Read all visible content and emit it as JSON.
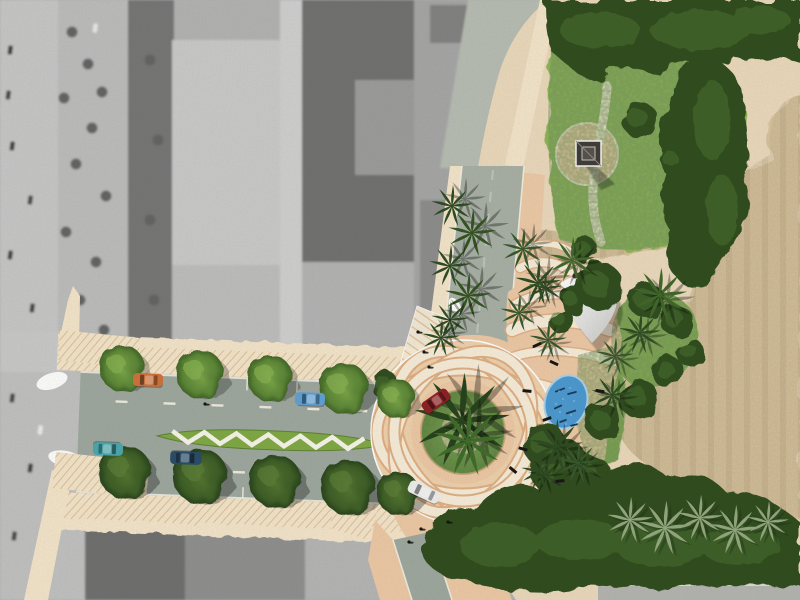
{
  "scene": {
    "kind": "urban-design-site-plan-over-aerial-photo",
    "features": [
      "grayscale-aerial-photo",
      "roundabout-with-guilloche-paving",
      "boulevard-with-chevron-median",
      "palm-trees",
      "park-lawn",
      "monument-plaza",
      "curved-park-path",
      "oval-pond",
      "shade-sail",
      "sand-field",
      "dense-foliage"
    ]
  },
  "palette": {
    "photoBase": "#b2b2b2",
    "planBase": "#ead8ba",
    "sand": "#d6c19a",
    "sandEdge": "#c9b288",
    "lawn": "#8cb355",
    "lawnDeep": "#6d9440",
    "foliageDark": "#2e4c1e",
    "foliageMid": "#49712f",
    "peach": "#ecc8a4",
    "peachDeep": "#dfae82",
    "cream": "#f6ecd8",
    "creamSide": "#f3e4c9",
    "hatchLine": "#dcc096",
    "road": "#9da79d",
    "roadNorth": "#a7afa4",
    "curb": "#f6f2e6",
    "median": "#7fa843",
    "chevron": "#f7f4ea",
    "pond": "#4a98cf",
    "pondRim": "#a9d0ea",
    "ripple": "#16395c",
    "sailWhite": "#f4f4f2",
    "sailDark": "#4a4038",
    "monument": "#3e3a36",
    "palmDark": "#2c4a21",
    "palmMid": "#3e6628",
    "palmPale": "#93a77e"
  },
  "objects": {
    "foliageBlobs": [
      {
        "x": 600,
        "y": 287,
        "r": 24
      },
      {
        "x": 646,
        "y": 300,
        "r": 18
      },
      {
        "x": 676,
        "y": 320,
        "r": 16
      },
      {
        "x": 690,
        "y": 352,
        "r": 14
      },
      {
        "x": 668,
        "y": 372,
        "r": 16
      },
      {
        "x": 638,
        "y": 398,
        "r": 20
      },
      {
        "x": 603,
        "y": 422,
        "r": 18
      },
      {
        "x": 572,
        "y": 300,
        "r": 13
      },
      {
        "x": 560,
        "y": 320,
        "r": 12
      },
      {
        "x": 585,
        "y": 250,
        "r": 13
      },
      {
        "x": 640,
        "y": 120,
        "r": 18
      },
      {
        "x": 672,
        "y": 160,
        "r": 14
      },
      {
        "x": 385,
        "y": 385,
        "r": 14
      },
      {
        "x": 560,
        "y": 468,
        "r": 30
      },
      {
        "x": 545,
        "y": 445,
        "r": 22
      },
      {
        "x": 588,
        "y": 478,
        "r": 24
      }
    ],
    "trees": [
      {
        "x": 122,
        "y": 368,
        "s": 1.0,
        "t": "L"
      },
      {
        "x": 200,
        "y": 374,
        "s": 1.05,
        "t": "L"
      },
      {
        "x": 270,
        "y": 378,
        "s": 1.0,
        "t": "L"
      },
      {
        "x": 344,
        "y": 388,
        "s": 1.1,
        "t": "L"
      },
      {
        "x": 396,
        "y": 398,
        "s": 0.85,
        "t": "L"
      },
      {
        "x": 125,
        "y": 472,
        "s": 1.1,
        "t": "D"
      },
      {
        "x": 200,
        "y": 476,
        "s": 1.15,
        "t": "D"
      },
      {
        "x": 275,
        "y": 481,
        "s": 1.1,
        "t": "D"
      },
      {
        "x": 348,
        "y": 487,
        "s": 1.15,
        "t": "D"
      },
      {
        "x": 398,
        "y": 493,
        "s": 0.9,
        "t": "D"
      }
    ],
    "palms": [
      {
        "x": 452,
        "y": 206,
        "s": 1.0,
        "c": "#2c4a21",
        "sx": 13,
        "sy": -7
      },
      {
        "x": 472,
        "y": 233,
        "s": 1.15,
        "c": "#32521f",
        "sx": 13,
        "sy": -7
      },
      {
        "x": 450,
        "y": 266,
        "s": 1.0,
        "c": "#2c4a21",
        "sx": 13,
        "sy": -7
      },
      {
        "x": 468,
        "y": 296,
        "s": 1.1,
        "c": "#32521f",
        "sx": 13,
        "sy": -7
      },
      {
        "x": 450,
        "y": 320,
        "s": 0.9,
        "c": "#2c4a21",
        "sx": 12,
        "sy": -6
      },
      {
        "x": 523,
        "y": 249,
        "s": 1.0,
        "c": "#35562a",
        "sx": 10,
        "sy": -5
      },
      {
        "x": 538,
        "y": 283,
        "s": 1.1,
        "c": "#2c4a21",
        "sx": 10,
        "sy": -5
      },
      {
        "x": 519,
        "y": 313,
        "s": 0.9,
        "c": "#35562a",
        "sx": 10,
        "sy": -5
      },
      {
        "x": 441,
        "y": 338,
        "s": 0.9,
        "c": "#2c4a21",
        "sx": 8,
        "sy": -4
      },
      {
        "x": 572,
        "y": 260,
        "s": 1.1,
        "c": "#3e6628",
        "sx": 7,
        "sy": 4
      },
      {
        "x": 545,
        "y": 288,
        "s": 0.8,
        "c": "#2c4a21",
        "sx": 6,
        "sy": 4
      },
      {
        "x": 548,
        "y": 340,
        "s": 0.9,
        "c": "#35562a",
        "sx": 6,
        "sy": 4
      },
      {
        "x": 660,
        "y": 295,
        "s": 1.3,
        "c": "#3e6628",
        "sx": 8,
        "sy": 5
      },
      {
        "x": 640,
        "y": 333,
        "s": 1.0,
        "c": "#2c4a21",
        "sx": 7,
        "sy": 4
      },
      {
        "x": 615,
        "y": 356,
        "s": 0.9,
        "c": "#35562a",
        "sx": 6,
        "sy": 4
      },
      {
        "x": 612,
        "y": 395,
        "s": 1.0,
        "c": "#2c4a21",
        "sx": 6,
        "sy": 4
      },
      {
        "x": 556,
        "y": 446,
        "s": 1.3,
        "c": "#2c4a21",
        "sx": 7,
        "sy": 4
      },
      {
        "x": 578,
        "y": 463,
        "s": 1.0,
        "c": "#35562a",
        "sx": 6,
        "sy": 4
      },
      {
        "x": 540,
        "y": 472,
        "s": 0.9,
        "c": "#2c4a21",
        "sx": 6,
        "sy": 4
      },
      {
        "x": 462,
        "y": 421,
        "s": 2.3,
        "c": "#24401a",
        "sx": 14,
        "sy": -9
      },
      {
        "x": 468,
        "y": 441,
        "s": 1.7,
        "c": "#3e6a28",
        "sx": 10,
        "sy": -6
      }
    ],
    "palePalms": [
      {
        "x": 630,
        "y": 520,
        "s": 1.1
      },
      {
        "x": 665,
        "y": 528,
        "s": 1.3
      },
      {
        "x": 700,
        "y": 518,
        "s": 1.1
      },
      {
        "x": 735,
        "y": 530,
        "s": 1.2
      },
      {
        "x": 768,
        "y": 522,
        "s": 1.0
      }
    ],
    "cars": [
      {
        "x": 148,
        "y": 380,
        "a": 2,
        "c": "#cf7038",
        "l": 1.0
      },
      {
        "x": 310,
        "y": 399,
        "a": 2,
        "c": "#5f9fd4",
        "l": 1.0
      },
      {
        "x": 108,
        "y": 449,
        "a": 182,
        "c": "#49a7ad",
        "l": 1.0
      },
      {
        "x": 186,
        "y": 458,
        "a": 182,
        "c": "#274b67",
        "l": 1.05
      },
      {
        "x": 436,
        "y": 401,
        "a": -35,
        "c": "#8c1f22",
        "l": 1.0
      },
      {
        "x": 424,
        "y": 492,
        "a": 25,
        "c": "#ededed",
        "l": 1.1
      }
    ],
    "benches": [
      {
        "x": 537,
        "y": 345,
        "a": -25
      },
      {
        "x": 554,
        "y": 363,
        "a": 25
      },
      {
        "x": 527,
        "y": 391,
        "a": 5
      },
      {
        "x": 547,
        "y": 419,
        "a": -20
      },
      {
        "x": 523,
        "y": 449,
        "a": 15
      },
      {
        "x": 513,
        "y": 470,
        "a": 40
      },
      {
        "x": 560,
        "y": 481,
        "a": -5
      },
      {
        "x": 600,
        "y": 391,
        "a": 10
      }
    ],
    "pedestrians": [
      {
        "x": 424,
        "y": 352
      },
      {
        "x": 429,
        "y": 367
      },
      {
        "x": 418,
        "y": 332
      },
      {
        "x": 409,
        "y": 542
      },
      {
        "x": 421,
        "y": 529
      },
      {
        "x": 448,
        "y": 522
      },
      {
        "x": 205,
        "y": 404
      }
    ],
    "pondRipples": [
      {
        "x": 560,
        "y": 390,
        "a": -20,
        "l": 9
      },
      {
        "x": 572,
        "y": 393,
        "a": -15,
        "l": 8
      },
      {
        "x": 558,
        "y": 407,
        "a": -25,
        "l": 7
      },
      {
        "x": 571,
        "y": 412,
        "a": -18,
        "l": 9
      },
      {
        "x": 563,
        "y": 421,
        "a": -20,
        "l": 6
      },
      {
        "x": 574,
        "y": 425,
        "a": -15,
        "l": 6
      }
    ],
    "pondSpeckles": [
      {
        "x": 559,
        "y": 391
      },
      {
        "x": 570,
        "y": 388
      },
      {
        "x": 563,
        "y": 399
      },
      {
        "x": 574,
        "y": 401
      },
      {
        "x": 560,
        "y": 412
      },
      {
        "x": 571,
        "y": 415
      },
      {
        "x": 566,
        "y": 424
      },
      {
        "x": 556,
        "y": 404
      }
    ],
    "laneDashesTop": {
      "y": 62,
      "xs": [
        60,
        108,
        156,
        204,
        252,
        300
      ]
    },
    "laneDashesBottom": {
      "y": 128,
      "xs": [
        84,
        132,
        180,
        228,
        276
      ]
    },
    "parkingTicks": {
      "xs": [
        90,
        140,
        190,
        240,
        290,
        340
      ],
      "yTop": 36,
      "yBottom": 144
    },
    "medianChevron": {
      "x0": 118,
      "x1": 312,
      "yHi": 90.5,
      "yLo": 101.5,
      "step": 16
    },
    "photoCars": [
      {
        "x": 10,
        "y": 50,
        "c": "#3a3a3a"
      },
      {
        "x": 8,
        "y": 95,
        "c": "#444444"
      },
      {
        "x": 12,
        "y": 146,
        "c": "#3d3d3d"
      },
      {
        "x": 30,
        "y": 200,
        "c": "#484848"
      },
      {
        "x": 10,
        "y": 255,
        "c": "#3f3f3f"
      },
      {
        "x": 32,
        "y": 308,
        "c": "#424242"
      },
      {
        "x": 12,
        "y": 398,
        "c": "#454545"
      },
      {
        "x": 30,
        "y": 468,
        "c": "#3c3c3c"
      },
      {
        "x": 14,
        "y": 536,
        "c": "#464646"
      },
      {
        "x": 95,
        "y": 28,
        "c": "#e8e8e8"
      },
      {
        "x": 92,
        "y": 372,
        "c": "#e4e4e4"
      },
      {
        "x": 40,
        "y": 430,
        "c": "#ececec"
      }
    ],
    "photoTrees": [
      {
        "x": 72,
        "y": 32
      },
      {
        "x": 88,
        "y": 64
      },
      {
        "x": 102,
        "y": 92
      },
      {
        "x": 64,
        "y": 98
      },
      {
        "x": 92,
        "y": 128
      },
      {
        "x": 76,
        "y": 164
      },
      {
        "x": 106,
        "y": 196
      },
      {
        "x": 66,
        "y": 232
      },
      {
        "x": 96,
        "y": 262
      },
      {
        "x": 80,
        "y": 300
      },
      {
        "x": 104,
        "y": 330
      },
      {
        "x": 150,
        "y": 60
      },
      {
        "x": 158,
        "y": 140
      },
      {
        "x": 150,
        "y": 220
      },
      {
        "x": 154,
        "y": 300
      },
      {
        "x": 148,
        "y": 390
      },
      {
        "x": 152,
        "y": 455
      }
    ]
  }
}
